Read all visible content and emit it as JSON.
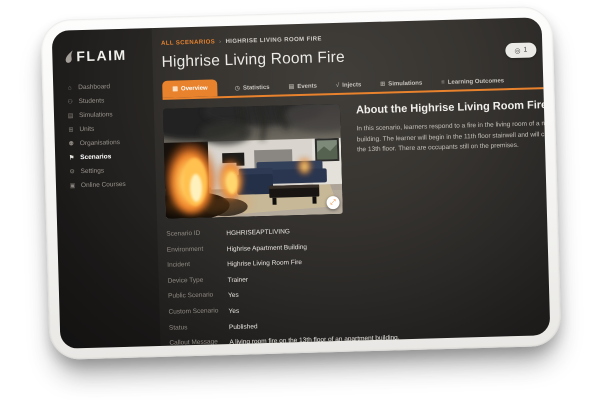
{
  "colors": {
    "accent": "#E8822D",
    "bezel": "#F6F5F3",
    "screen_bg": "#2E2C2A"
  },
  "sidebar": {
    "logo": "FLAIM",
    "items": [
      {
        "label": "Dashboard",
        "icon": "⌂"
      },
      {
        "label": "Students",
        "icon": "⚇"
      },
      {
        "label": "Simulations",
        "icon": "▤"
      },
      {
        "label": "Units",
        "icon": "⊞"
      },
      {
        "label": "Organisations",
        "icon": "⚉"
      },
      {
        "label": "Scenarios",
        "icon": "⚑"
      },
      {
        "label": "Settings",
        "icon": "⚙"
      },
      {
        "label": "Online Courses",
        "icon": "▣"
      }
    ]
  },
  "header": {
    "breadcrumb": {
      "parent": "ALL SCENARIOS",
      "separator": "›",
      "current": "HIGHRISE LIVING ROOM FIRE"
    },
    "title": "Highrise Living Room Fire",
    "partial_button": {
      "icon": "◎",
      "label": "1"
    }
  },
  "tabs": [
    {
      "label": "Overview",
      "icon": "▦"
    },
    {
      "label": "Statistics",
      "icon": "◷"
    },
    {
      "label": "Events",
      "icon": "▤"
    },
    {
      "label": "Injects",
      "icon": "√"
    },
    {
      "label": "Simulations",
      "icon": "⊞"
    },
    {
      "label": "Learning Outcomes",
      "icon": "≡"
    }
  ],
  "media": {
    "fullscreen_icon": "⤢"
  },
  "about": {
    "heading": "About the Highrise Living Room Fire scenario",
    "body": "In this scenario, learners respond to a fire in the living room of a multi-storey apartment building. The learner will begin in the 11th floor stairwell and will climb to apartment 4 on the 13th floor. There are occupants still on the premises."
  },
  "details": {
    "rows": [
      {
        "label": "Scenario ID",
        "value": "HGHRISEAPTLIVING"
      },
      {
        "label": "Environment",
        "value": "Highrise Apartment Building"
      },
      {
        "label": "Incident",
        "value": "Highrise Living Room Fire"
      },
      {
        "label": "Device Type",
        "value": "Trainer"
      },
      {
        "label": "Public Scenario",
        "value": "Yes"
      },
      {
        "label": "Custom Scenario",
        "value": "Yes"
      },
      {
        "label": "Status",
        "value": "Published"
      },
      {
        "label": "Callout Message",
        "value": "A living room fire on the 13th floor of an apartment building."
      }
    ]
  }
}
